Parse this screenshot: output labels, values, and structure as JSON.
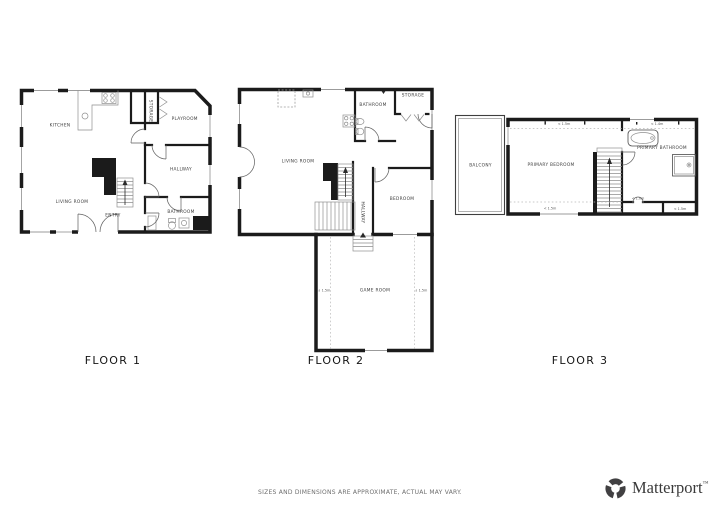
{
  "floor1": {
    "label": "FLOOR 1",
    "rooms": {
      "kitchen": "KITCHEN",
      "storage": "STORAGE",
      "playroom": "PLAYROOM",
      "hallway": "HALLWAY",
      "living_room": "LIVING ROOM",
      "entry": "ENTRY",
      "bathroom": "BATHROOM"
    }
  },
  "floor2": {
    "label": "FLOOR 2",
    "rooms": {
      "living_room": "LIVING ROOM",
      "bathroom": "BATHROOM",
      "storage": "STORAGE",
      "bedroom": "BEDROOM",
      "hallway": "HALLWAY",
      "game_room": "GAME ROOM"
    },
    "dims": {
      "game_left": "↓ 1.5m",
      "game_right": "↓ 1.5m"
    }
  },
  "floor3": {
    "label": "FLOOR 3",
    "rooms": {
      "balcony": "BALCONY",
      "primary_bedroom": "PRIMARY BEDROOM",
      "primary_bathroom": "PRIMARY BATHROOM"
    },
    "dims": {
      "top_center": "< 1.5m",
      "top_right": "< 1.4m",
      "bottom_left": "< 1.5m",
      "bottom_center": "< 1.0m",
      "bottom_right": "< 1.5m"
    }
  },
  "footer": {
    "disclaimer": "SIZES AND DIMENSIONS ARE APPROXIMATE, ACTUAL MAY VARY."
  },
  "brand": {
    "name": "Matterport",
    "trademark": "™"
  },
  "colors": {
    "wall": "#1b1b1b",
    "thin_line": "#8f8f8f",
    "label_text": "#3c3c3c",
    "logo": "#414042"
  }
}
